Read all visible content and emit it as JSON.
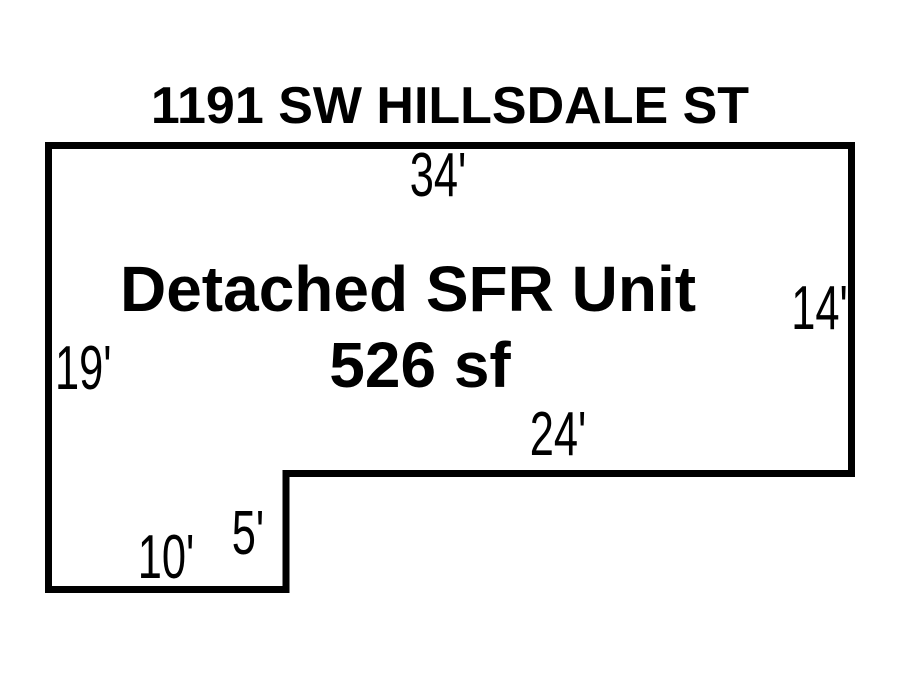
{
  "colors": {
    "background": "#ffffff",
    "line": "#000000",
    "text": "#000000"
  },
  "sketch": {
    "address": "1191 SW HILLSDALE ST",
    "building": {
      "label": "Detached SFR Unit",
      "area": "526 sf"
    },
    "dimensions": {
      "top": "34'",
      "left": "19'",
      "right": "14'",
      "bottom_right": "24'",
      "notch": "5'",
      "bottom_left": "10'"
    },
    "outline_points": "48.5,145.5 851.5,145.5 851.5,473.5 286,473.5 286,589.5 48.5,589.5"
  }
}
